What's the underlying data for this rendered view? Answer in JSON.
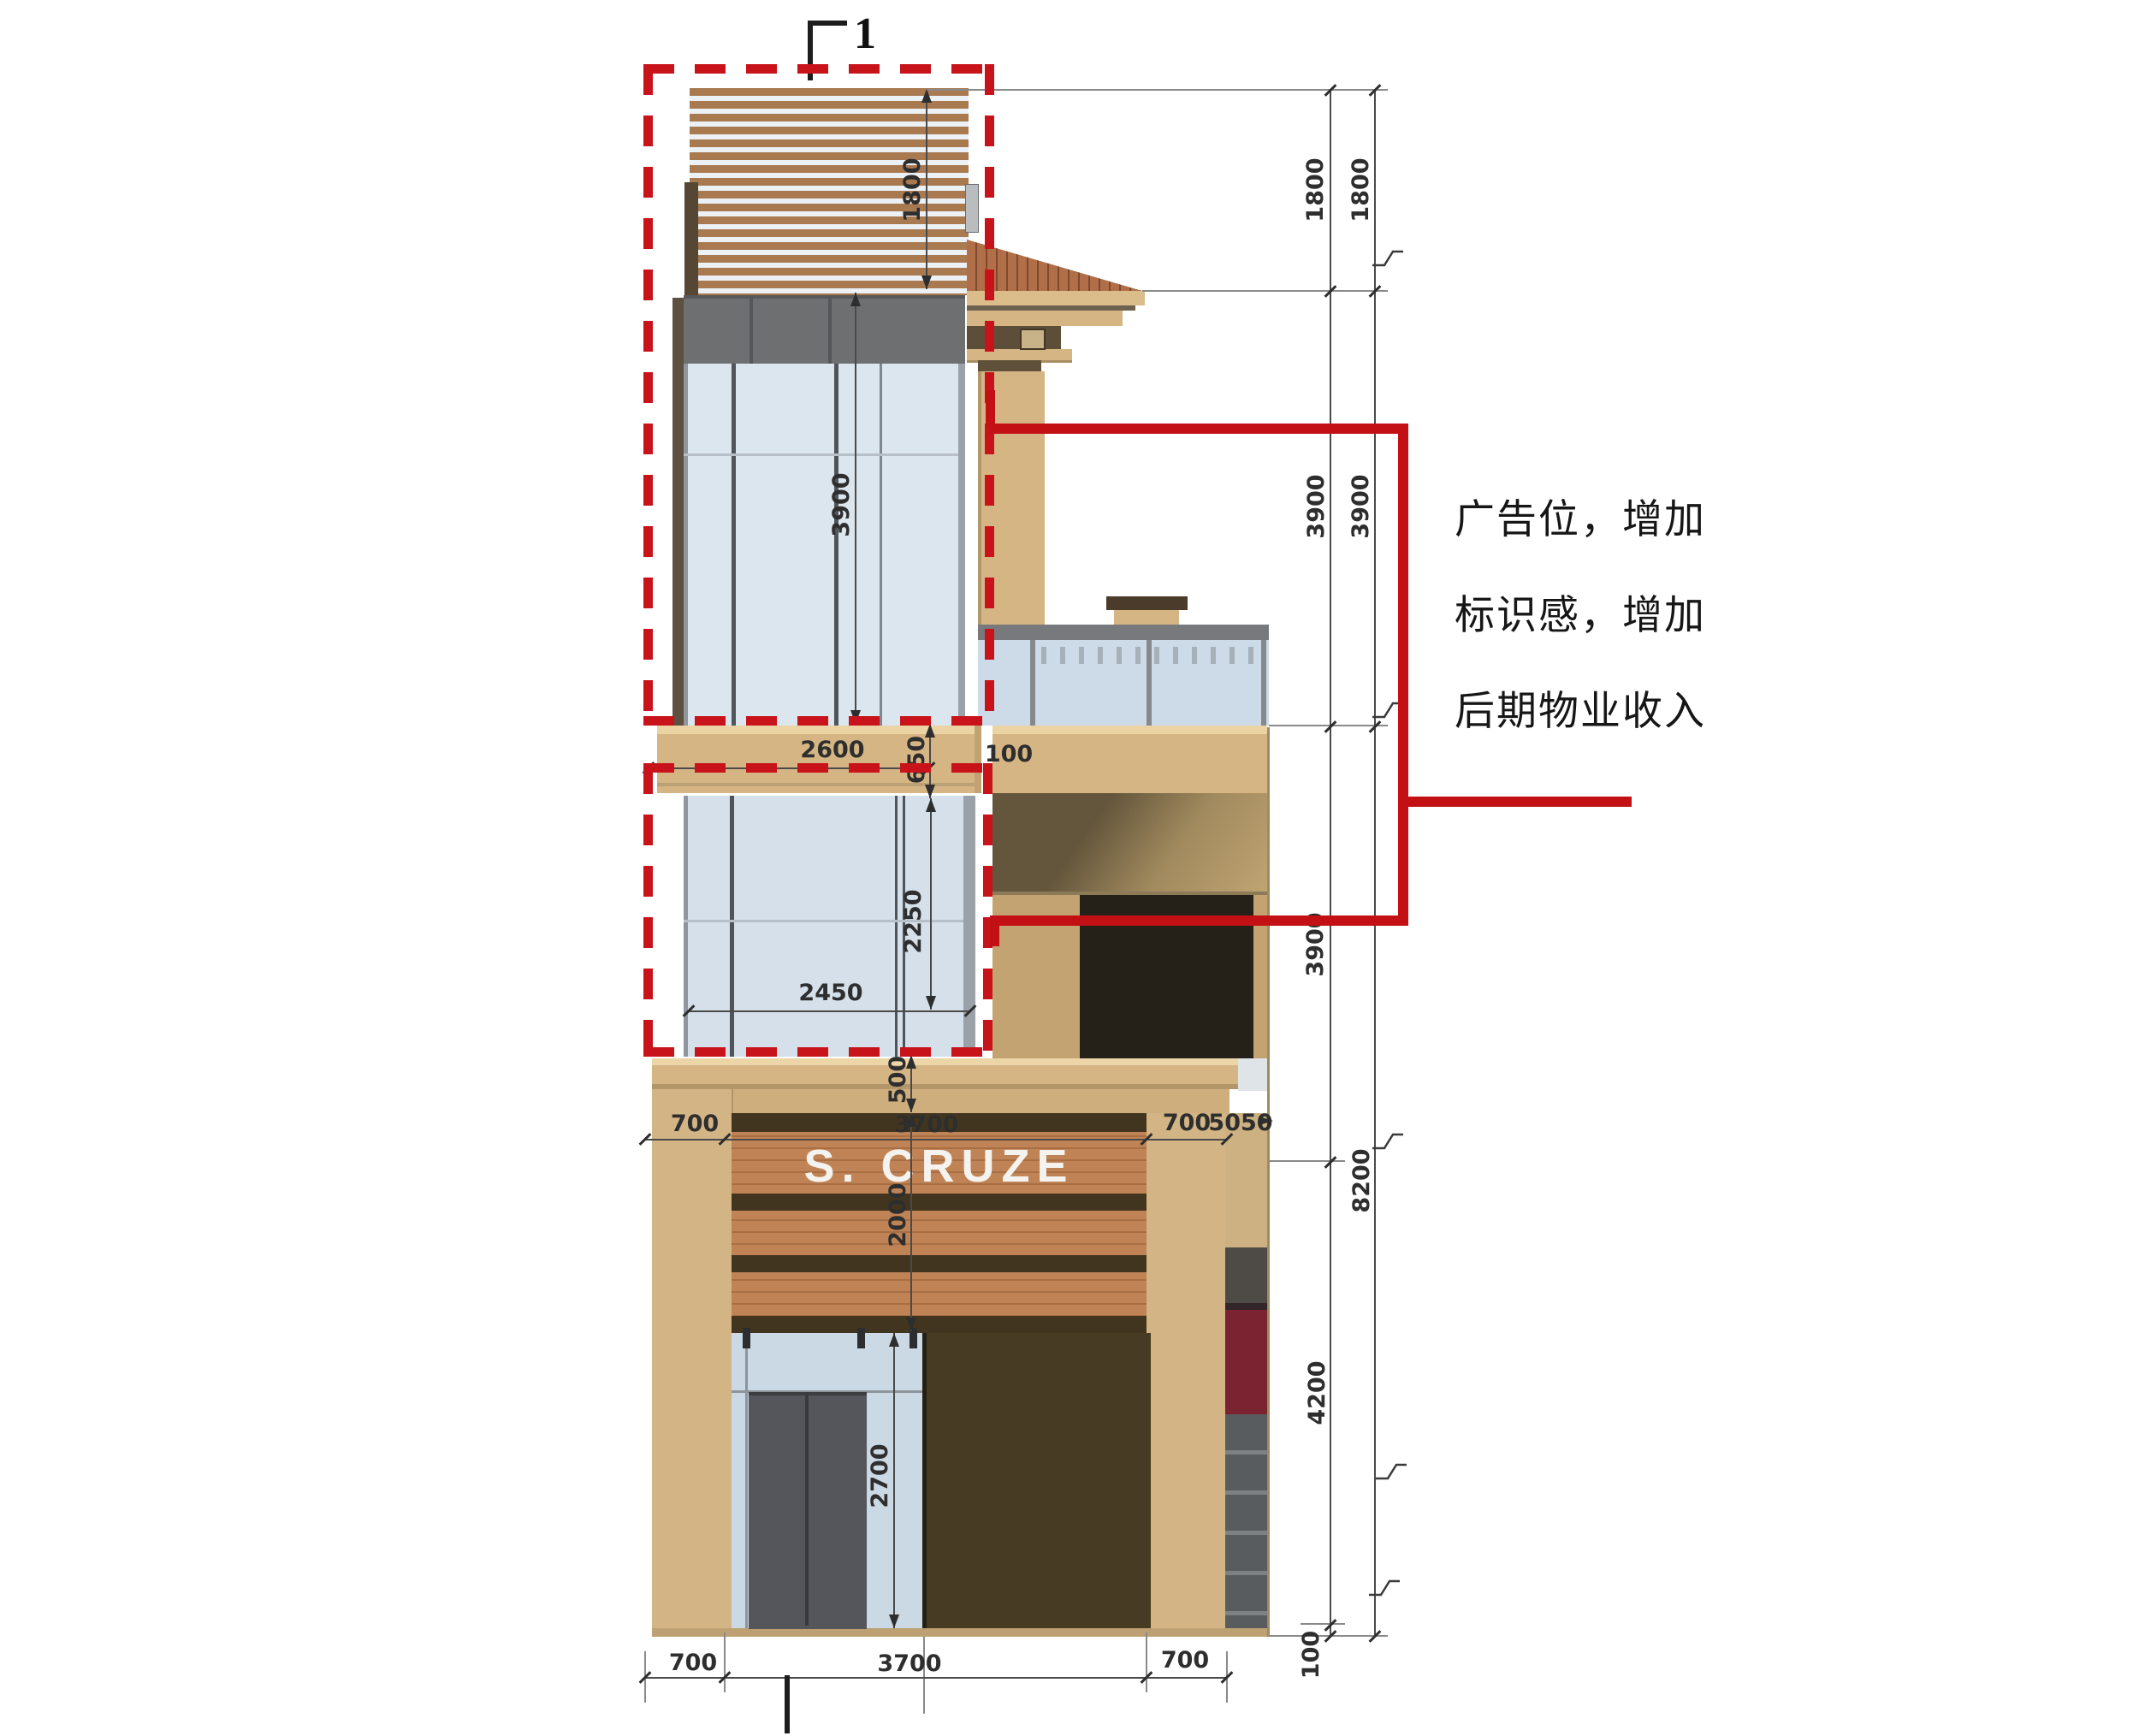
{
  "annotation": {
    "lines": [
      "广告位，增加",
      "标识感，增加",
      "后期物业收入"
    ]
  },
  "section_marker": {
    "label": "1"
  },
  "sign": {
    "text": "S. CRUZE"
  },
  "colors": {
    "annotation_red": "#c8131a",
    "wall_tan": "#d6b584",
    "roof_tile": "#b06f48",
    "glass_blue": "#d5e0ea",
    "dark_panel": "#473b23",
    "awning_maroon": "#7c2331"
  },
  "dims": {
    "louver_h": "1800",
    "tower_upper_h": "3900",
    "beam_w": "2600",
    "beam_h": "650",
    "gap_100": "100",
    "tower_lower_h": "2250",
    "tower_lower_w": "2450",
    "parapet_h": "500",
    "mid_pier_l": "700",
    "mid_bay": "3700",
    "mid_pier_r": "700",
    "mid_total": "5050",
    "sign_h": "2000",
    "door_h": "2700",
    "bot_pier_l": "700",
    "bot_bay": "3700",
    "bot_pier_r": "700",
    "chain_inner": [
      "1800",
      "3900",
      "3900",
      "4200",
      "100"
    ],
    "chain_outer": [
      "1800",
      "3900",
      "8200"
    ]
  }
}
